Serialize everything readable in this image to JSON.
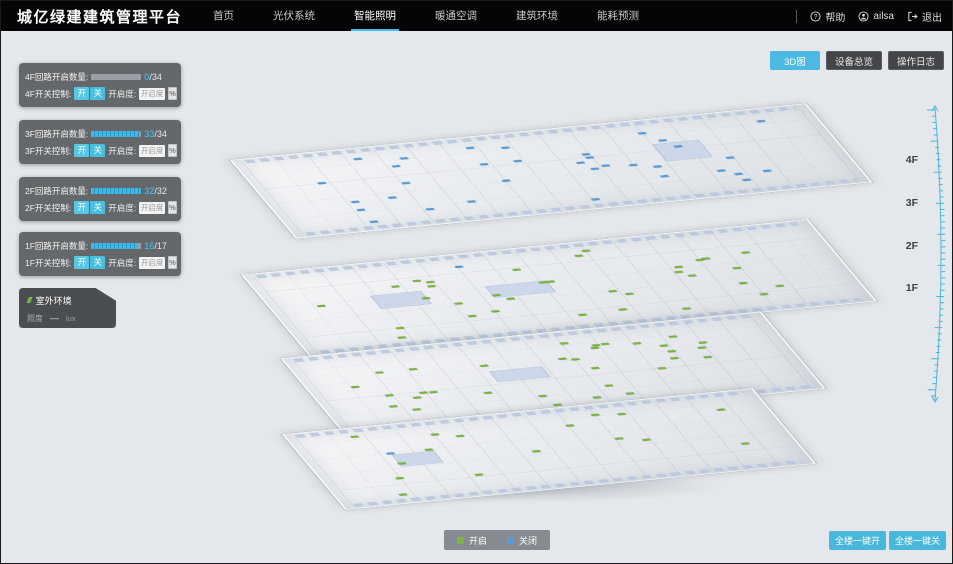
{
  "app_title": "城亿绿建建筑管理平台",
  "nav": {
    "active_index": 2,
    "items": [
      {
        "label": "首页"
      },
      {
        "label": "光伏系统"
      },
      {
        "label": "智能照明"
      },
      {
        "label": "暖通空调"
      },
      {
        "label": "建筑环境"
      },
      {
        "label": "能耗预测"
      }
    ]
  },
  "user_bar": {
    "help": "帮助",
    "username": "ailsa",
    "logout": "退出"
  },
  "view_toolbar": {
    "buttons": [
      {
        "label": "3D图",
        "active": true
      },
      {
        "label": "设备总览",
        "active": false
      },
      {
        "label": "操作日志",
        "active": false
      }
    ]
  },
  "floor_panels": [
    {
      "floor": "4F",
      "count_label": "4F回路开启数量:",
      "open": 0,
      "total": 34,
      "total_text": "/34",
      "switch_label": "4F开关控制:",
      "on": "开",
      "off": "关",
      "dim_label": "开启度:",
      "dim_placeholder": "开启度",
      "percent": "%"
    },
    {
      "floor": "3F",
      "count_label": "3F回路开启数量:",
      "open": 33,
      "total": 34,
      "total_text": "/34",
      "switch_label": "3F开关控制:",
      "on": "开",
      "off": "关",
      "dim_label": "开启度:",
      "dim_placeholder": "开启度",
      "percent": "%"
    },
    {
      "floor": "2F",
      "count_label": "2F回路开启数量:",
      "open": 32,
      "total": 32,
      "total_text": "/32",
      "switch_label": "2F开关控制:",
      "on": "开",
      "off": "关",
      "dim_label": "开启度:",
      "dim_placeholder": "开启度",
      "percent": "%"
    },
    {
      "floor": "1F",
      "count_label": "1F回路开启数量:",
      "open": 16,
      "total": 17,
      "total_text": "/17",
      "switch_label": "1F开关控制:",
      "on": "开",
      "off": "关",
      "dim_label": "开启度:",
      "dim_placeholder": "开启度",
      "percent": "%"
    }
  ],
  "outdoor": {
    "title": "室外环境",
    "metric": "照度",
    "value": "—",
    "unit": "lux"
  },
  "floor_axis": [
    "4F",
    "3F",
    "2F",
    "1F"
  ],
  "legend": {
    "on": "开启",
    "off": "关闭"
  },
  "bulk_actions": {
    "all_on": "全楼一键开",
    "all_off": "全楼一键关"
  },
  "colors": {
    "accent": "#3ec0ea",
    "on": "#7cb342",
    "off": "#5b9bd5"
  }
}
